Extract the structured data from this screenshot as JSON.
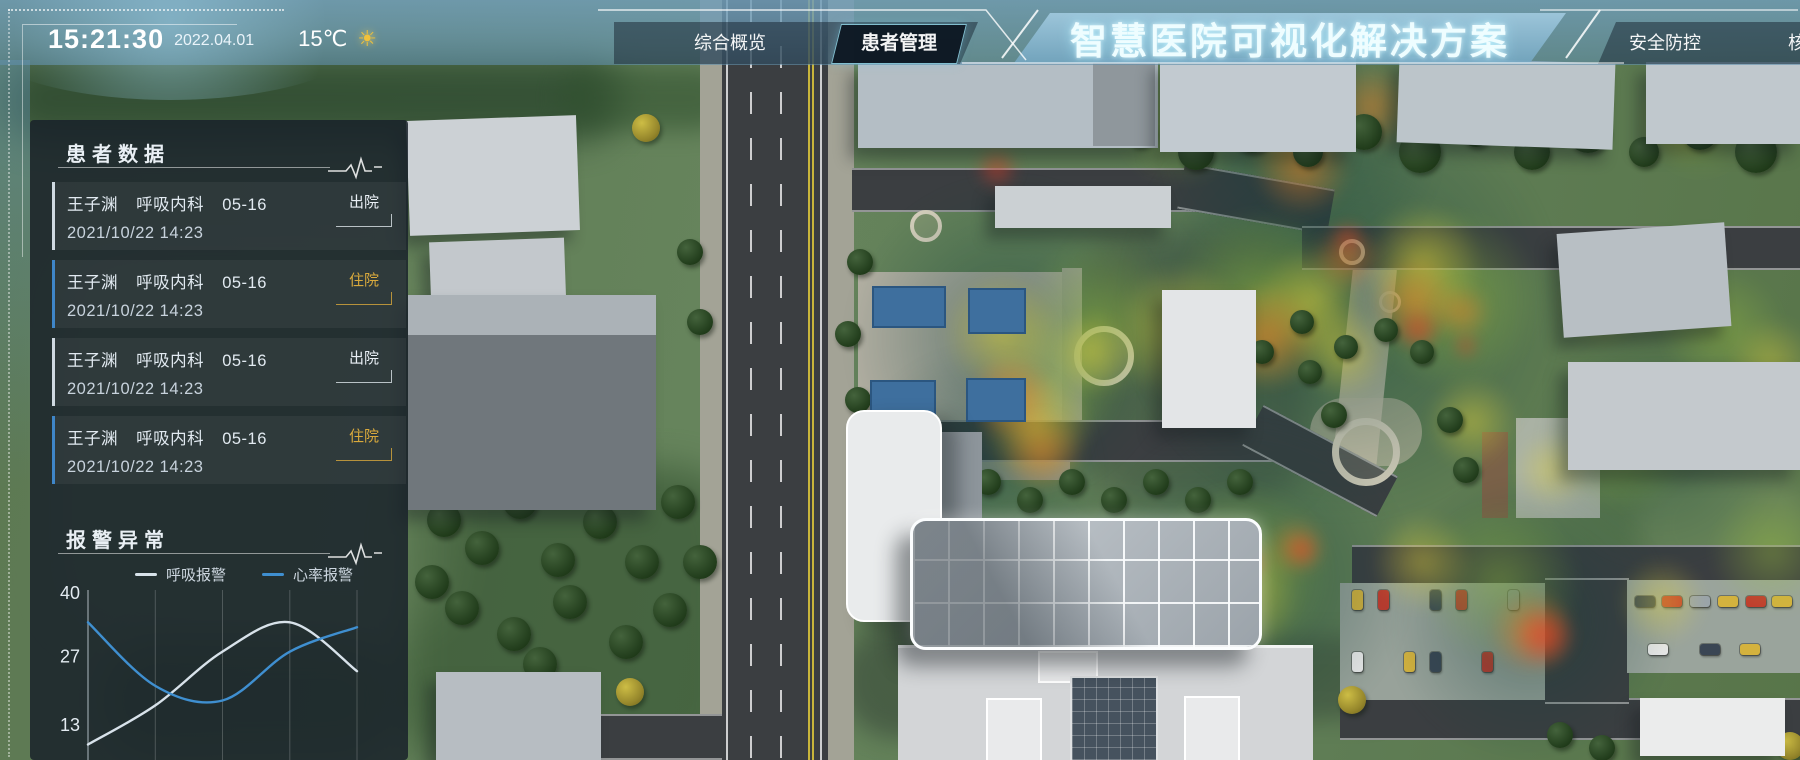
{
  "header": {
    "time": "15:21:30",
    "date": "2022.04.01",
    "temperature": "15℃",
    "weather": "sunny",
    "weather_icon": "☀",
    "title": "智慧医院可视化解决方案",
    "tabs_left": [
      {
        "label": "综合概览",
        "active": false
      },
      {
        "label": "患者管理",
        "active": true
      }
    ],
    "tabs_right": [
      {
        "label": "安全防控",
        "active": false
      },
      {
        "label": "核",
        "active": false,
        "clipped": true
      }
    ]
  },
  "patient_panel": {
    "title": "患者数据",
    "items": [
      {
        "name": "王子渊",
        "department": "呼吸内科",
        "bed": "05-16",
        "datetime": "2021/10/22 14:23",
        "status": "出院",
        "status_type": "discharged"
      },
      {
        "name": "王子渊",
        "department": "呼吸内科",
        "bed": "05-16",
        "datetime": "2021/10/22 14:23",
        "status": "住院",
        "status_type": "inpatient"
      },
      {
        "name": "王子渊",
        "department": "呼吸内科",
        "bed": "05-16",
        "datetime": "2021/10/22 14:23",
        "status": "出院",
        "status_type": "discharged"
      },
      {
        "name": "王子渊",
        "department": "呼吸内科",
        "bed": "05-16",
        "datetime": "2021/10/22 14:23",
        "status": "住院",
        "status_type": "inpatient"
      }
    ]
  },
  "alarm_panel": {
    "title": "报警异常",
    "legend": [
      {
        "label": "呼吸报警",
        "color": "#d8e2ea"
      },
      {
        "label": "心率报警",
        "color": "#3f8fd0"
      }
    ]
  },
  "chart_data": {
    "type": "line",
    "title": "报警异常",
    "x": [
      0,
      1,
      2,
      3,
      4
    ],
    "series": [
      {
        "name": "呼吸报警",
        "color": "#d8e2ea",
        "values": [
          9,
          17,
          28,
          34,
          24
        ]
      },
      {
        "name": "心率报警",
        "color": "#3f8fd0",
        "values": [
          34,
          21,
          18,
          28,
          33
        ]
      }
    ],
    "yticks": [
      40,
      27,
      13
    ],
    "ylim": [
      6,
      40
    ],
    "grid": "vertical",
    "legend_position": "top",
    "x_axis_labels_visible": false
  }
}
